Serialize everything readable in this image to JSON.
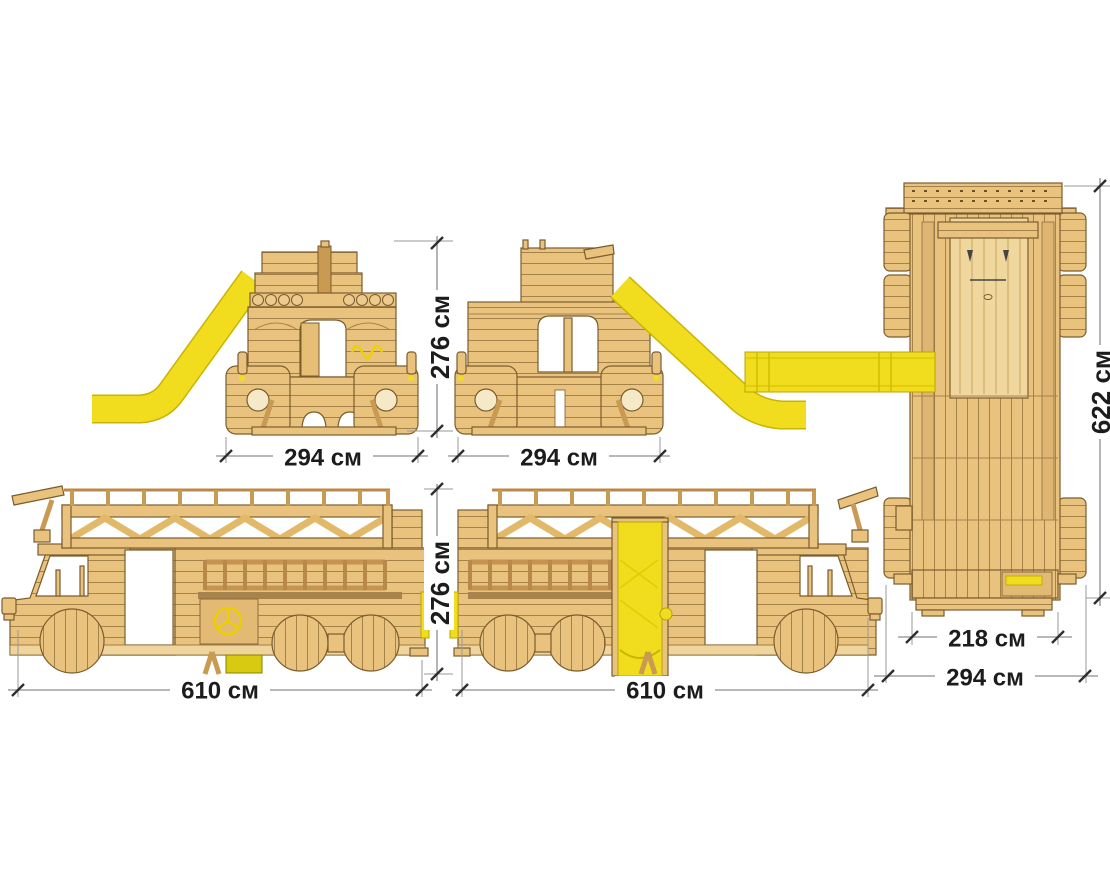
{
  "drawing": {
    "unit": "см",
    "dimensions": {
      "front_width": {
        "value": 294,
        "label": "294 см"
      },
      "rear_width": {
        "value": 294,
        "label": "294 см"
      },
      "upper_height": {
        "value": 276,
        "label": "276 см"
      },
      "lower_height": {
        "value": 276,
        "label": "276 см"
      },
      "plan_length": {
        "value": 622,
        "label": "622 см"
      },
      "plan_inner_width": {
        "value": 218,
        "label": "218 см"
      },
      "plan_overall_width": {
        "value": 294,
        "label": "294 см"
      },
      "side_left_length": {
        "value": 610,
        "label": "610 см"
      },
      "side_right_length": {
        "value": 610,
        "label": "610 см"
      }
    },
    "colors": {
      "wood": "#e9c37e",
      "wood_dark": "#c89a52",
      "outline": "#7a5c2e",
      "slide_yellow": "#f1dd1e",
      "dimension_line": "#8d8d8d",
      "dimension_text": "#1c1c1c",
      "background": "#ffffff"
    }
  }
}
